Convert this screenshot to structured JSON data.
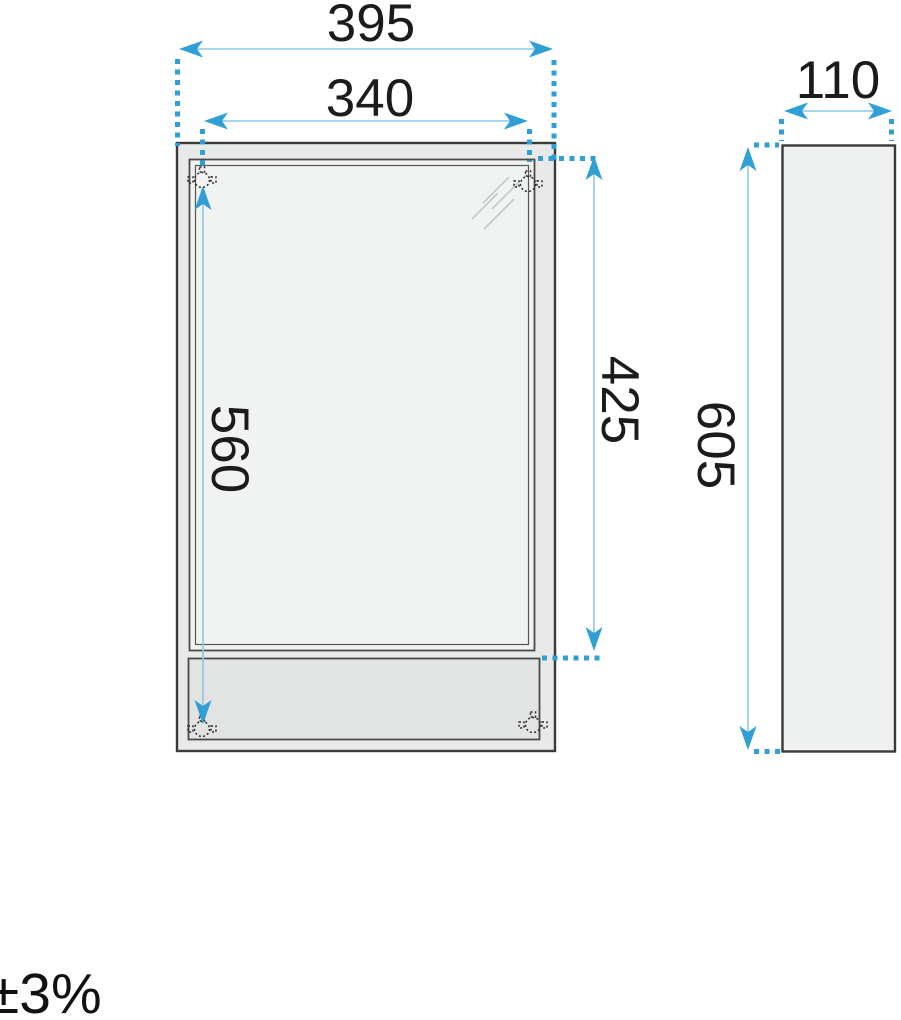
{
  "front_view": {
    "outer_width": "395",
    "door_width": "340",
    "hole_spacing_height": "560",
    "door_height": "425"
  },
  "side_view": {
    "depth": "110",
    "height": "605"
  },
  "tolerance": "±3%",
  "colors": {
    "dimension_accent": "#2f9fd4",
    "dimension_line": "#8cc8e6",
    "outline_dark": "#3a3a3a"
  }
}
